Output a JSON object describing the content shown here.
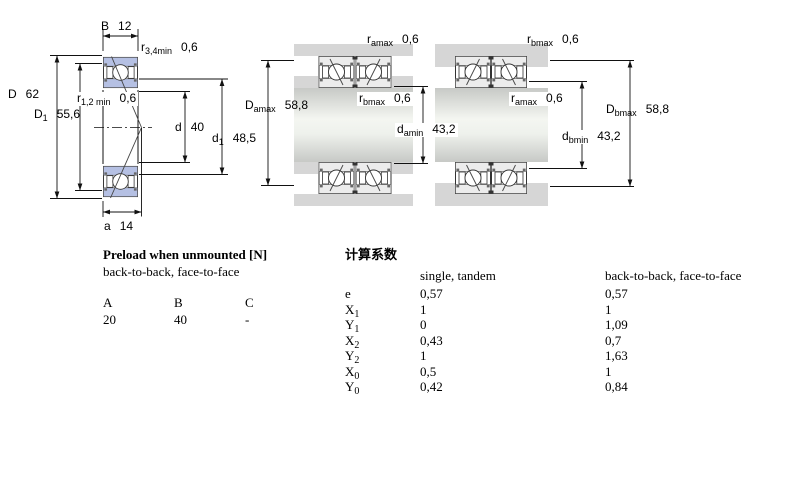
{
  "dims": {
    "B": {
      "name": "B",
      "sub": "",
      "value": "12"
    },
    "r34": {
      "name": "r",
      "sub": "3,4min",
      "value": "0,6"
    },
    "D": {
      "name": "D",
      "sub": "",
      "value": "62"
    },
    "D1": {
      "name": "D",
      "sub": "1",
      "value": "55,6"
    },
    "r12": {
      "name": "r",
      "sub": "1,2 min",
      "value": "0,6"
    },
    "d": {
      "name": "d",
      "sub": "",
      "value": "40"
    },
    "d1": {
      "name": "d",
      "sub": "1",
      "value": "48,5"
    },
    "a": {
      "name": "a",
      "sub": "",
      "value": "14"
    },
    "ramax": {
      "name": "r",
      "sub": "amax",
      "value": "0,6"
    },
    "Damax": {
      "name": "D",
      "sub": "amax",
      "value": "58,8"
    },
    "rbmax": {
      "name": "r",
      "sub": "bmax",
      "value": "0,6"
    },
    "damin": {
      "name": "d",
      "sub": "amin",
      "value": "43,2"
    },
    "rbmax2": {
      "name": "r",
      "sub": "bmax",
      "value": "0,6"
    },
    "ramax2": {
      "name": "r",
      "sub": "amax",
      "value": "0,6"
    },
    "Dbmax": {
      "name": "D",
      "sub": "bmax",
      "value": "58,8"
    },
    "dbmin": {
      "name": "d",
      "sub": "bmin",
      "value": "43,2"
    }
  },
  "preload": {
    "title": "Preload when unmounted [N]",
    "subtitle": "back-to-back, face-to-face",
    "columns": [
      "A",
      "B",
      "C"
    ],
    "values": [
      "20",
      "40",
      "-"
    ]
  },
  "factors": {
    "title": "计算系数",
    "col1_header": "single, tandem",
    "col2_header": "back-to-back, face-to-face",
    "rows": [
      {
        "name": "e",
        "sub": "",
        "single": "0,57",
        "paired": "0,57"
      },
      {
        "name": "X",
        "sub": "1",
        "single": "1",
        "paired": "1"
      },
      {
        "name": "Y",
        "sub": "1",
        "single": "0",
        "paired": "1,09"
      },
      {
        "name": "X",
        "sub": "2",
        "single": "0,43",
        "paired": "0,7"
      },
      {
        "name": "Y",
        "sub": "2",
        "single": "1",
        "paired": "1,63"
      },
      {
        "name": "X",
        "sub": "0",
        "single": "0,5",
        "paired": "1"
      },
      {
        "name": "Y",
        "sub": "0",
        "single": "0,42",
        "paired": "0,84"
      }
    ]
  }
}
